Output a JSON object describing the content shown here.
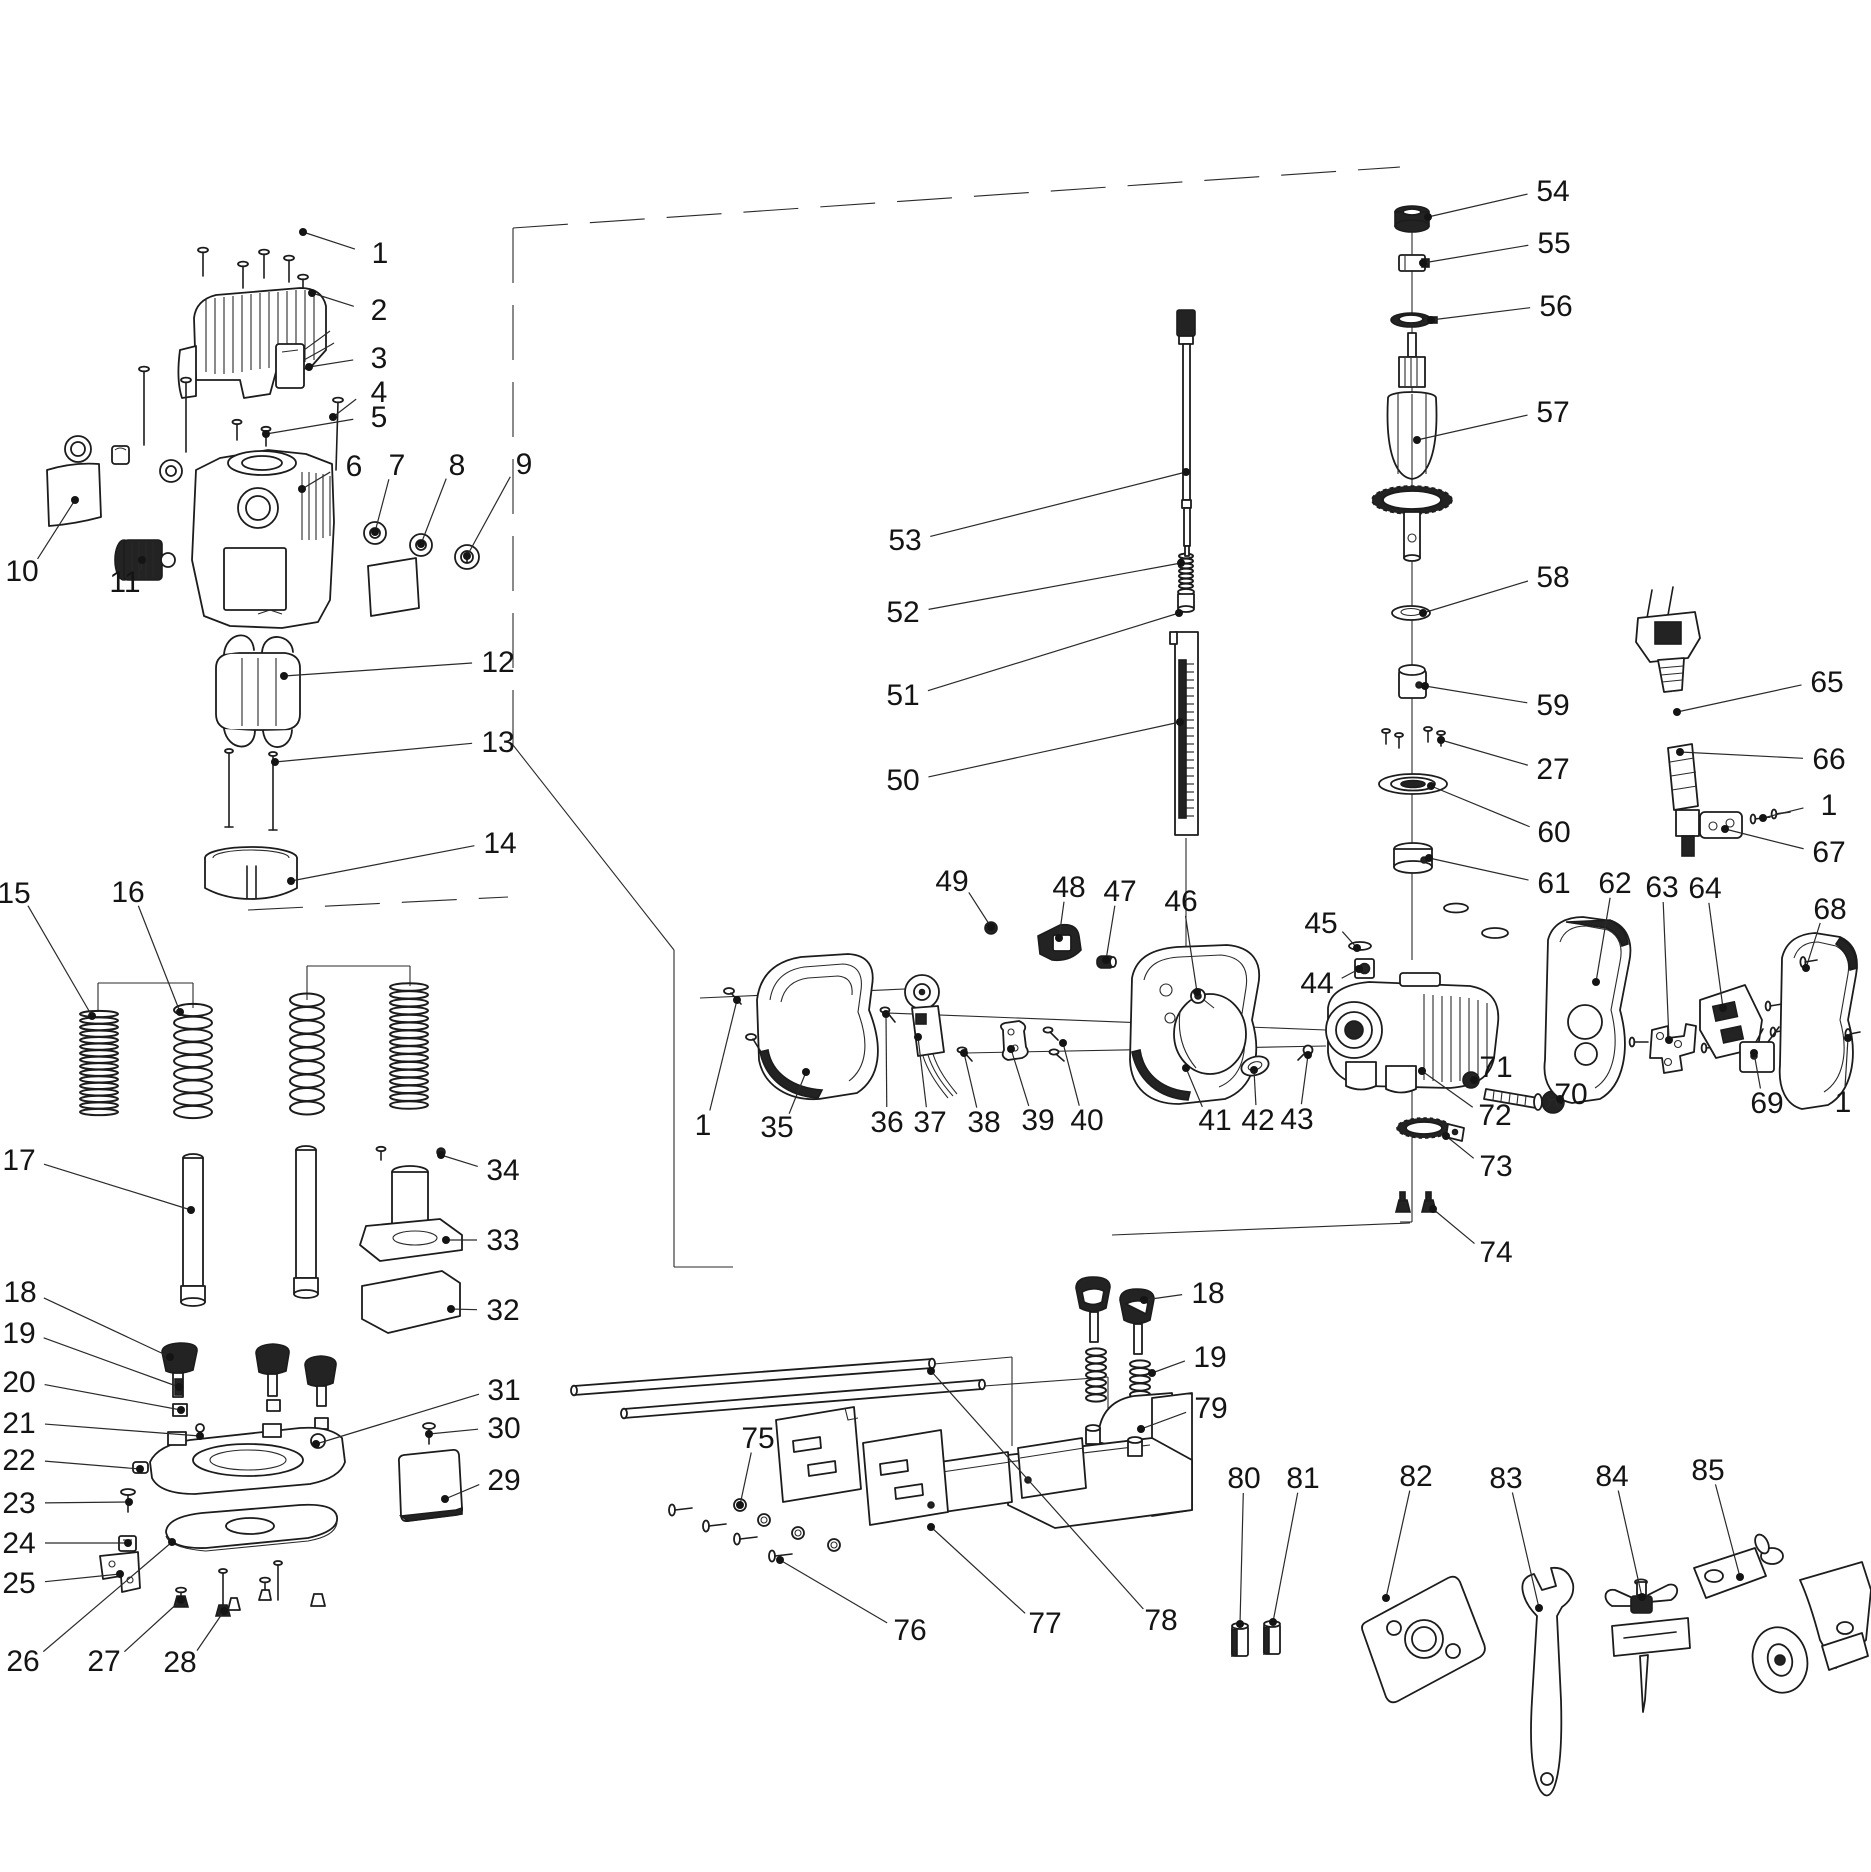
{
  "meta": {
    "background_color": "#ffffff",
    "line_color": "#1c1c1c",
    "leader_color": "#2a2a2a",
    "label_color": "#141414",
    "label_font_size": 30
  },
  "callouts": [
    {
      "num": "1",
      "lx": 380,
      "ly": 253,
      "tx": 303,
      "ty": 232
    },
    {
      "num": "2",
      "lx": 379,
      "ly": 310,
      "tx": 312,
      "ty": 293
    },
    {
      "num": "3",
      "lx": 379,
      "ly": 358,
      "tx": 309,
      "ty": 367
    },
    {
      "num": "4",
      "lx": 379,
      "ly": 392,
      "tx": 333,
      "ty": 417
    },
    {
      "num": "5",
      "lx": 379,
      "ly": 417,
      "tx": 266,
      "ty": 434
    },
    {
      "num": "6",
      "lx": 354,
      "ly": 466,
      "tx": 302,
      "ty": 489
    },
    {
      "num": "7",
      "lx": 397,
      "ly": 465,
      "tx": 375,
      "ty": 532
    },
    {
      "num": "8",
      "lx": 457,
      "ly": 465,
      "tx": 421,
      "ty": 544
    },
    {
      "num": "9",
      "lx": 524,
      "ly": 464,
      "tx": 467,
      "ty": 556
    },
    {
      "num": "10",
      "lx": 22,
      "ly": 571,
      "tx": 75,
      "ty": 500
    },
    {
      "num": "11",
      "lx": 125,
      "ly": 582,
      "tx": 142,
      "ty": 560
    },
    {
      "num": "12",
      "lx": 498,
      "ly": 662,
      "tx": 284,
      "ty": 676
    },
    {
      "num": "13",
      "lx": 498,
      "ly": 742,
      "tx": 275,
      "ty": 762
    },
    {
      "num": "14",
      "lx": 500,
      "ly": 843,
      "tx": 291,
      "ty": 881
    },
    {
      "num": "15",
      "lx": 14,
      "ly": 893,
      "tx": 92,
      "ty": 1016
    },
    {
      "num": "16",
      "lx": 128,
      "ly": 892,
      "tx": 180,
      "ty": 1012
    },
    {
      "num": "17",
      "lx": 19,
      "ly": 1160,
      "tx": 191,
      "ty": 1210
    },
    {
      "num": "18",
      "lx": 20,
      "ly": 1292,
      "tx": 170,
      "ty": 1357
    },
    {
      "num": "19",
      "lx": 19,
      "ly": 1333,
      "tx": 179,
      "ty": 1387
    },
    {
      "num": "20",
      "lx": 19,
      "ly": 1382,
      "tx": 181,
      "ty": 1410
    },
    {
      "num": "21",
      "lx": 19,
      "ly": 1423,
      "tx": 200,
      "ty": 1436
    },
    {
      "num": "22",
      "lx": 19,
      "ly": 1460,
      "tx": 140,
      "ty": 1469
    },
    {
      "num": "23",
      "lx": 19,
      "ly": 1503,
      "tx": 129,
      "ty": 1502
    },
    {
      "num": "24",
      "lx": 19,
      "ly": 1543,
      "tx": 128,
      "ty": 1543
    },
    {
      "num": "25",
      "lx": 19,
      "ly": 1583,
      "tx": 120,
      "ty": 1574
    },
    {
      "num": "26",
      "lx": 23,
      "ly": 1661,
      "tx": 172,
      "ty": 1542
    },
    {
      "num": "27",
      "lx": 104,
      "ly": 1661,
      "tx": 181,
      "ty": 1600
    },
    {
      "num": "28",
      "lx": 180,
      "ly": 1662,
      "tx": 224,
      "ty": 1611
    },
    {
      "num": "29",
      "lx": 504,
      "ly": 1480,
      "tx": 445,
      "ty": 1499
    },
    {
      "num": "30",
      "lx": 504,
      "ly": 1428,
      "tx": 429,
      "ty": 1434
    },
    {
      "num": "31",
      "lx": 504,
      "ly": 1390,
      "tx": 316,
      "ty": 1444
    },
    {
      "num": "32",
      "lx": 503,
      "ly": 1310,
      "tx": 451,
      "ty": 1309
    },
    {
      "num": "33",
      "lx": 503,
      "ly": 1240,
      "tx": 446,
      "ty": 1240
    },
    {
      "num": "34",
      "lx": 503,
      "ly": 1170,
      "tx": 441,
      "ty": 1155
    },
    {
      "num": "53",
      "lx": 905,
      "ly": 540,
      "tx": 1186,
      "ty": 472
    },
    {
      "num": "52",
      "lx": 903,
      "ly": 612,
      "tx": 1181,
      "ty": 563
    },
    {
      "num": "51",
      "lx": 903,
      "ly": 695,
      "tx": 1179,
      "ty": 613
    },
    {
      "num": "50",
      "lx": 903,
      "ly": 780,
      "tx": 1180,
      "ty": 722
    },
    {
      "num": "1",
      "lx": 703,
      "ly": 1125,
      "tx": 737,
      "ty": 1000
    },
    {
      "num": "35",
      "lx": 777,
      "ly": 1127,
      "tx": 806,
      "ty": 1072
    },
    {
      "num": "36",
      "lx": 887,
      "ly": 1122,
      "tx": 886,
      "ty": 1014
    },
    {
      "num": "37",
      "lx": 930,
      "ly": 1122,
      "tx": 918,
      "ty": 1037
    },
    {
      "num": "38",
      "lx": 984,
      "ly": 1122,
      "tx": 964,
      "ty": 1053
    },
    {
      "num": "39",
      "lx": 1038,
      "ly": 1120,
      "tx": 1011,
      "ty": 1049
    },
    {
      "num": "40",
      "lx": 1087,
      "ly": 1120,
      "tx": 1063,
      "ty": 1043
    },
    {
      "num": "41",
      "lx": 1215,
      "ly": 1120,
      "tx": 1186,
      "ty": 1068
    },
    {
      "num": "42",
      "lx": 1258,
      "ly": 1120,
      "tx": 1254,
      "ty": 1070
    },
    {
      "num": "43",
      "lx": 1297,
      "ly": 1119,
      "tx": 1308,
      "ty": 1055
    },
    {
      "num": "44",
      "lx": 1317,
      "ly": 983,
      "tx": 1359,
      "ty": 969
    },
    {
      "num": "45",
      "lx": 1321,
      "ly": 923,
      "tx": 1357,
      "ty": 948
    },
    {
      "num": "46",
      "lx": 1181,
      "ly": 901,
      "tx": 1197,
      "ty": 992
    },
    {
      "num": "47",
      "lx": 1120,
      "ly": 891,
      "tx": 1106,
      "ty": 960
    },
    {
      "num": "48",
      "lx": 1069,
      "ly": 887,
      "tx": 1059,
      "ty": 938
    },
    {
      "num": "49",
      "lx": 952,
      "ly": 881,
      "tx": 991,
      "ty": 927
    },
    {
      "num": "54",
      "lx": 1553,
      "ly": 191,
      "tx": 1428,
      "ty": 217
    },
    {
      "num": "55",
      "lx": 1554,
      "ly": 243,
      "tx": 1423,
      "ty": 263
    },
    {
      "num": "56",
      "lx": 1556,
      "ly": 306,
      "tx": 1431,
      "ty": 320
    },
    {
      "num": "57",
      "lx": 1553,
      "ly": 412,
      "tx": 1417,
      "ty": 440
    },
    {
      "num": "58",
      "lx": 1553,
      "ly": 577,
      "tx": 1423,
      "ty": 613
    },
    {
      "num": "59",
      "lx": 1553,
      "ly": 705,
      "tx": 1425,
      "ty": 686
    },
    {
      "num": "27",
      "lx": 1553,
      "ly": 769,
      "tx": 1441,
      "ty": 740
    },
    {
      "num": "60",
      "lx": 1554,
      "ly": 832,
      "tx": 1431,
      "ty": 786
    },
    {
      "num": "61",
      "lx": 1554,
      "ly": 883,
      "tx": 1429,
      "ty": 858
    },
    {
      "num": "62",
      "lx": 1615,
      "ly": 883,
      "tx": 1596,
      "ty": 982
    },
    {
      "num": "63",
      "lx": 1662,
      "ly": 887,
      "tx": 1669,
      "ty": 1040
    },
    {
      "num": "64",
      "lx": 1705,
      "ly": 888,
      "tx": 1723,
      "ty": 1008
    },
    {
      "num": "65",
      "lx": 1827,
      "ly": 682,
      "tx": 1677,
      "ty": 712
    },
    {
      "num": "66",
      "lx": 1829,
      "ly": 759,
      "tx": 1680,
      "ty": 752
    },
    {
      "num": "1",
      "lx": 1829,
      "ly": 805,
      "tx": 1763,
      "ty": 818
    },
    {
      "num": "67",
      "lx": 1829,
      "ly": 852,
      "tx": 1725,
      "ty": 829
    },
    {
      "num": "68",
      "lx": 1830,
      "ly": 909,
      "tx": 1806,
      "ty": 968
    },
    {
      "num": "69",
      "lx": 1767,
      "ly": 1103,
      "tx": 1754,
      "ty": 1053
    },
    {
      "num": "1",
      "lx": 1843,
      "ly": 1102,
      "tx": 1848,
      "ty": 1038
    },
    {
      "num": "70",
      "lx": 1571,
      "ly": 1094,
      "tx": 1560,
      "ty": 1099
    },
    {
      "num": "71",
      "lx": 1496,
      "ly": 1067,
      "tx": 1474,
      "ty": 1080
    },
    {
      "num": "72",
      "lx": 1495,
      "ly": 1115,
      "tx": 1422,
      "ty": 1071
    },
    {
      "num": "73",
      "lx": 1496,
      "ly": 1166,
      "tx": 1446,
      "ty": 1136
    },
    {
      "num": "74",
      "lx": 1496,
      "ly": 1252,
      "tx": 1433,
      "ty": 1209
    },
    {
      "num": "18",
      "lx": 1208,
      "ly": 1293,
      "tx": 1144,
      "ty": 1300
    },
    {
      "num": "19",
      "lx": 1210,
      "ly": 1357,
      "tx": 1152,
      "ty": 1373
    },
    {
      "num": "79",
      "lx": 1211,
      "ly": 1408,
      "tx": 1141,
      "ty": 1429
    },
    {
      "num": "75",
      "lx": 758,
      "ly": 1438,
      "tx": 740,
      "ty": 1505
    },
    {
      "num": "76",
      "lx": 910,
      "ly": 1630,
      "tx": 780,
      "ty": 1560
    },
    {
      "num": "77",
      "lx": 1045,
      "ly": 1623,
      "tx": 931,
      "ty": 1527
    },
    {
      "num": "78",
      "lx": 1161,
      "ly": 1620,
      "tx": 931,
      "ty": 1371
    },
    {
      "num": "80",
      "lx": 1244,
      "ly": 1478,
      "tx": 1240,
      "ty": 1624
    },
    {
      "num": "81",
      "lx": 1303,
      "ly": 1478,
      "tx": 1273,
      "ty": 1622
    },
    {
      "num": "82",
      "lx": 1416,
      "ly": 1476,
      "tx": 1386,
      "ty": 1598
    },
    {
      "num": "83",
      "lx": 1506,
      "ly": 1478,
      "tx": 1539,
      "ty": 1608
    },
    {
      "num": "84",
      "lx": 1612,
      "ly": 1476,
      "tx": 1642,
      "ty": 1597
    },
    {
      "num": "85",
      "lx": 1708,
      "ly": 1470,
      "tx": 1740,
      "ty": 1577
    }
  ],
  "springs": [
    {
      "name": "plunge-spring-outer-left",
      "cx": 99,
      "rx": 19,
      "top": 1014,
      "bottom": 1112,
      "coils": 15
    },
    {
      "name": "plunge-spring-inner-left",
      "cx": 193,
      "rx": 19,
      "top": 1010,
      "bottom": 1112,
      "coils": 8
    },
    {
      "name": "plunge-spring-inner-right",
      "cx": 307,
      "rx": 17,
      "top": 1000,
      "bottom": 1108,
      "coils": 8
    },
    {
      "name": "plunge-spring-outer-right",
      "cx": 409,
      "rx": 19,
      "top": 987,
      "bottom": 1105,
      "coils": 15
    },
    {
      "name": "guide-knob-spring-1",
      "cx": 1096,
      "rx": 10,
      "top": 1352,
      "bottom": 1398,
      "coils": 6
    },
    {
      "name": "guide-knob-spring-2",
      "cx": 1140,
      "rx": 10,
      "top": 1364,
      "bottom": 1410,
      "coils": 6
    },
    {
      "name": "depth-rod-spring",
      "cx": 1186,
      "rx": 7,
      "top": 556,
      "bottom": 586,
      "coils": 6
    }
  ],
  "ruler_ticks": {
    "x": 1186,
    "len": 8,
    "top": 664,
    "bottom": 816,
    "step": 8
  },
  "construction_lines": [
    {
      "x1": 513,
      "y1": 228,
      "x2": 1400,
      "y2": 167,
      "dash": true
    },
    {
      "x1": 513,
      "y1": 228,
      "x2": 513,
      "y2": 745,
      "dash": true
    },
    {
      "x1": 248,
      "y1": 910,
      "x2": 508,
      "y2": 897,
      "dash": true
    },
    {
      "x1": 513,
      "y1": 745,
      "x2": 674,
      "y2": 950,
      "dash": false
    },
    {
      "x1": 674,
      "y1": 950,
      "x2": 674,
      "y2": 1267,
      "dash": false
    },
    {
      "x1": 674,
      "y1": 1267,
      "x2": 733,
      "y2": 1267,
      "dash": false
    },
    {
      "x1": 1412,
      "y1": 232,
      "x2": 1412,
      "y2": 960,
      "dash": false
    },
    {
      "x1": 1412,
      "y1": 1088,
      "x2": 1412,
      "y2": 1222,
      "dash": false
    },
    {
      "x1": 1412,
      "y1": 1222,
      "x2": 1400,
      "y2": 1222,
      "dash": false
    },
    {
      "x1": 1112,
      "y1": 1235,
      "x2": 1410,
      "y2": 1223,
      "dash": false
    },
    {
      "x1": 934,
      "y1": 1364,
      "x2": 1012,
      "y2": 1357,
      "dash": false
    },
    {
      "x1": 1012,
      "y1": 1357,
      "x2": 1012,
      "y2": 1446,
      "dash": false
    },
    {
      "x1": 984,
      "y1": 1386,
      "x2": 1108,
      "y2": 1377,
      "dash": false
    },
    {
      "x1": 1108,
      "y1": 1377,
      "x2": 1108,
      "y2": 1452,
      "dash": false
    },
    {
      "x1": 98,
      "y1": 1012,
      "x2": 98,
      "y2": 983,
      "dash": false
    },
    {
      "x1": 98,
      "y1": 983,
      "x2": 193,
      "y2": 983,
      "dash": false
    },
    {
      "x1": 193,
      "y1": 983,
      "x2": 193,
      "y2": 1008,
      "dash": false
    },
    {
      "x1": 307,
      "y1": 1000,
      "x2": 307,
      "y2": 966,
      "dash": false
    },
    {
      "x1": 307,
      "y1": 966,
      "x2": 410,
      "y2": 966,
      "dash": false
    },
    {
      "x1": 410,
      "y1": 966,
      "x2": 410,
      "y2": 986,
      "dash": false
    },
    {
      "x1": 700,
      "y1": 998,
      "x2": 928,
      "y2": 988,
      "dash": false
    },
    {
      "x1": 888,
      "y1": 1013,
      "x2": 1326,
      "y2": 1030,
      "dash": false
    },
    {
      "x1": 965,
      "y1": 1053,
      "x2": 1326,
      "y2": 1046,
      "dash": false
    },
    {
      "x1": 1186,
      "y1": 838,
      "x2": 1186,
      "y2": 950,
      "dash": false
    }
  ]
}
